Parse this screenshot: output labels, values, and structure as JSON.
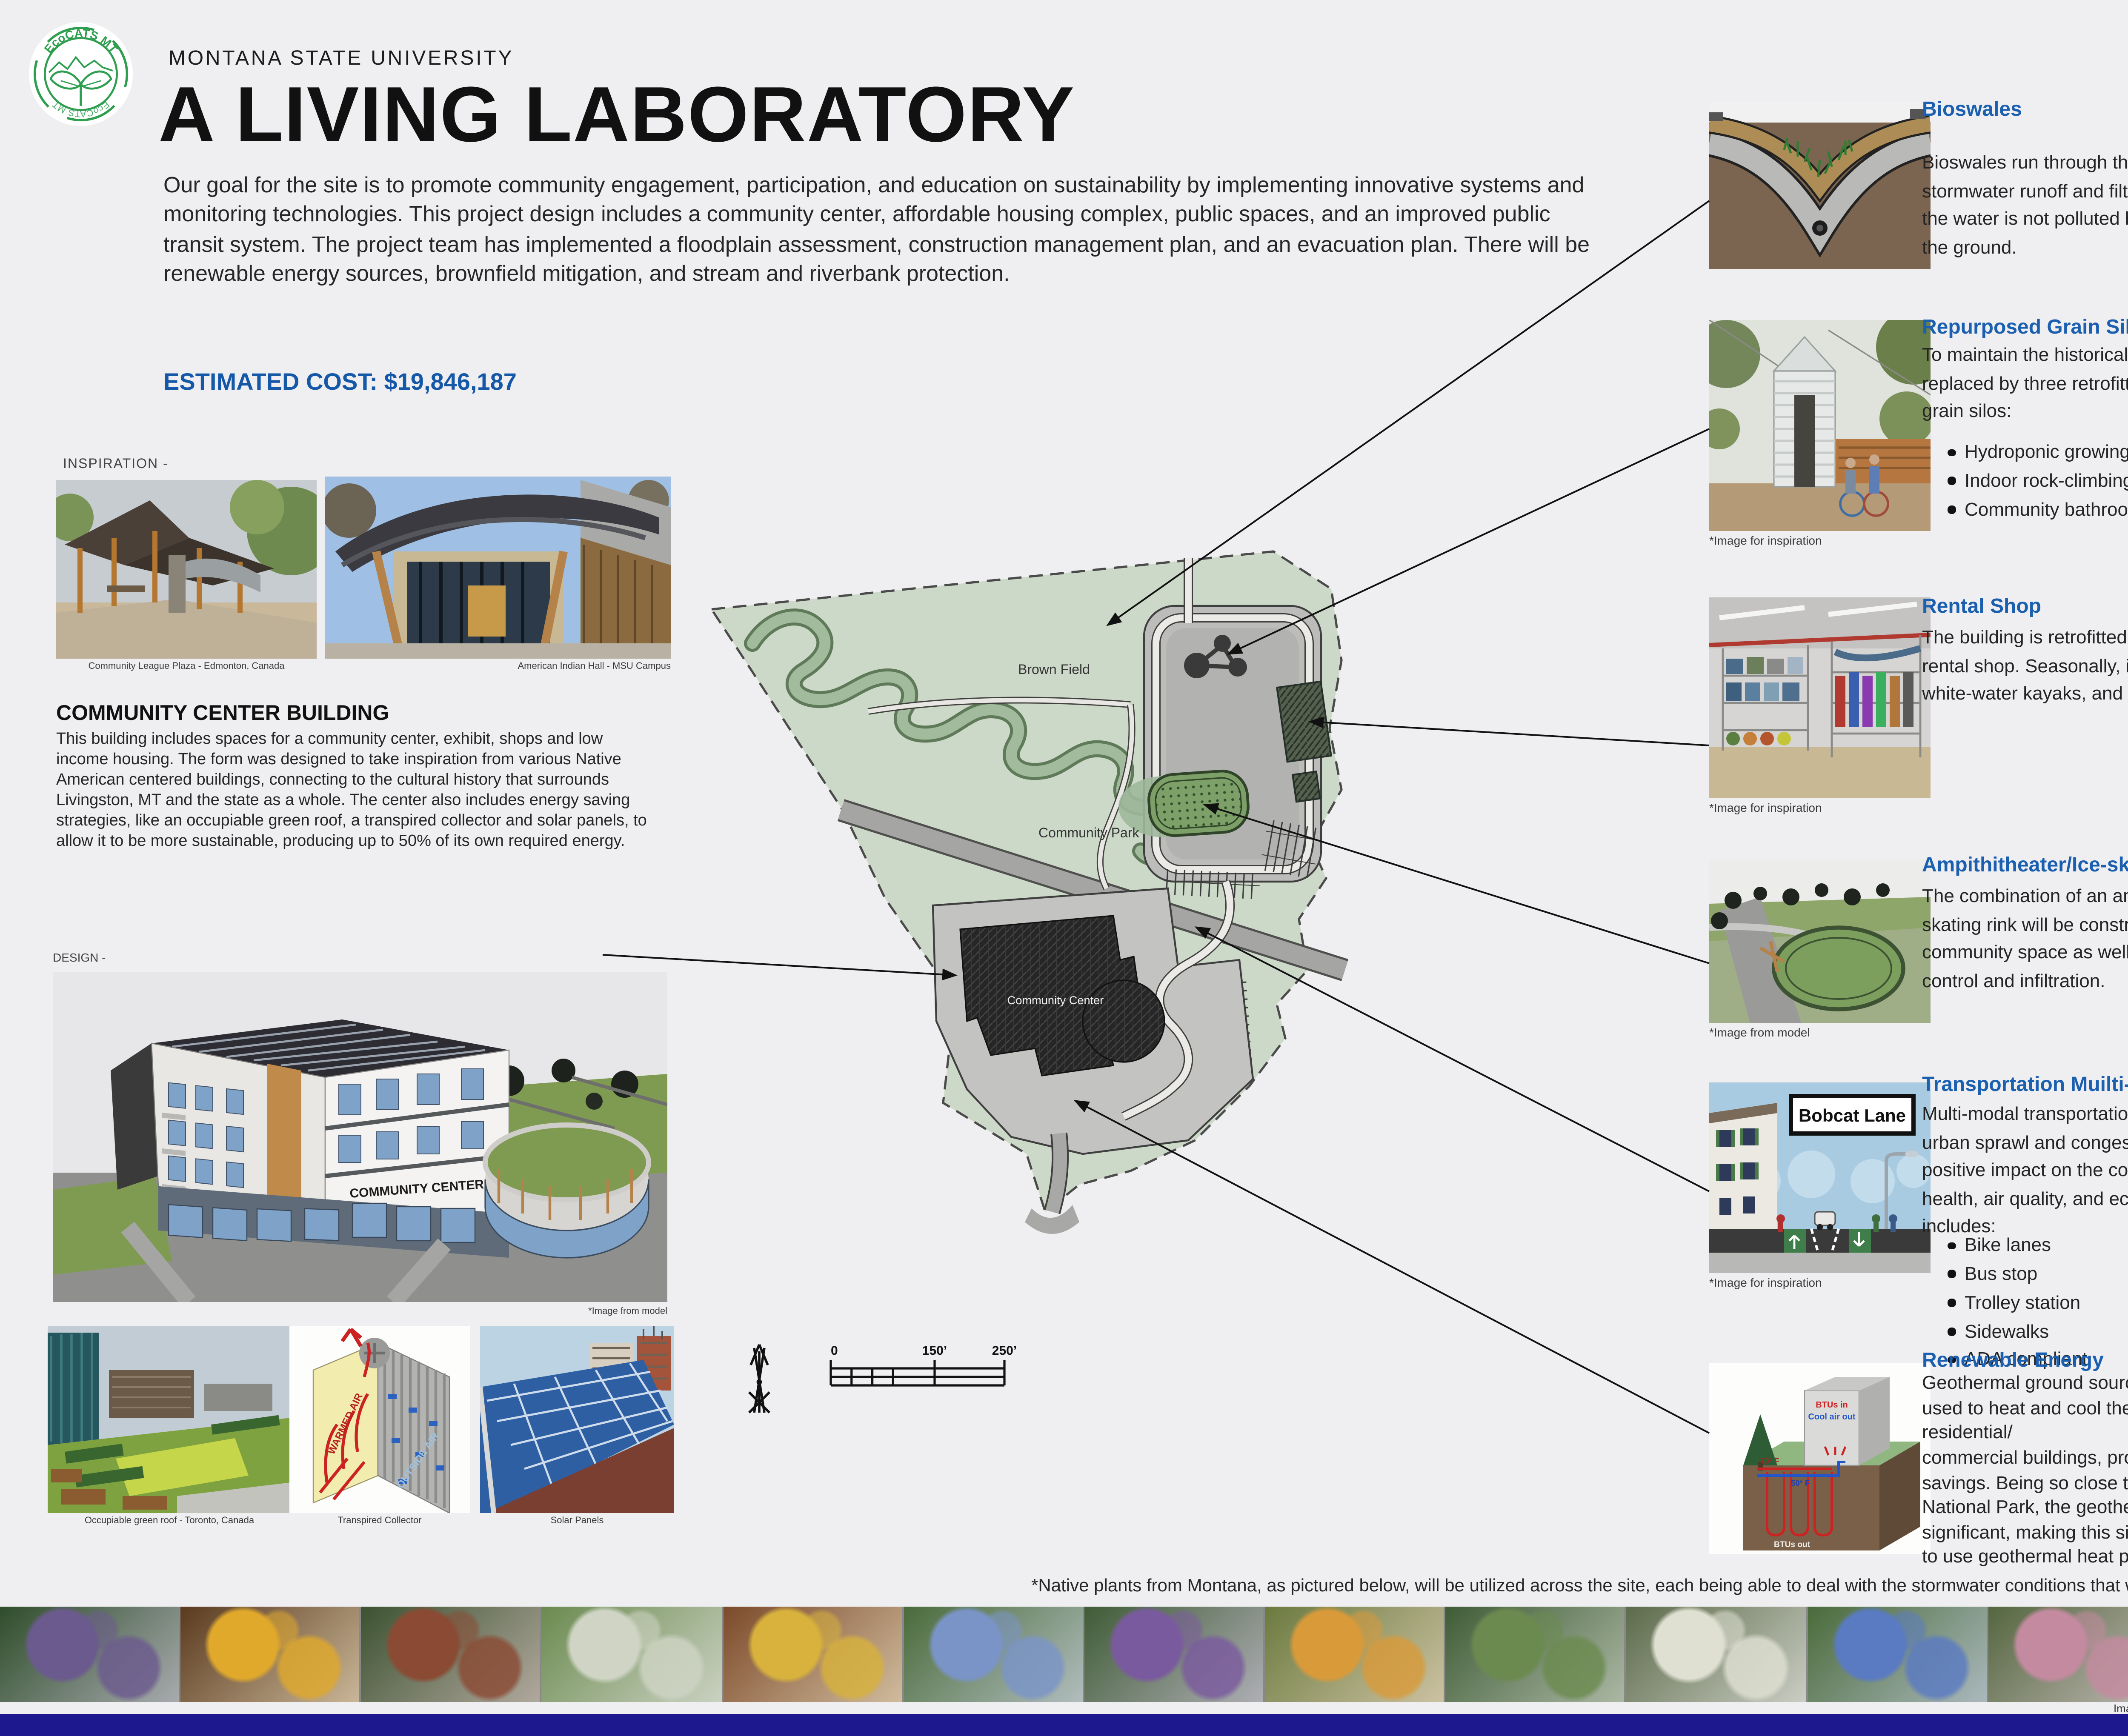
{
  "header": {
    "logo_text": "EcoCATS MT",
    "university": "MONTANA STATE UNIVERSITY",
    "title": "A LIVING LABORATORY",
    "intro": "Our goal for the site is to promote community engagement, participation, and education on sustainability by implementing innovative systems and monitoring technologies. This project design includes a community center, affordable housing complex, public spaces, and an improved public transit system. The project team has implemented a floodplain assessment, construction management plan, and an evacuation plan. There will be renewable energy sources, brownfield mitigation, and stream and riverbank protection.",
    "estimated_cost": "ESTIMATED COST: $19,846,187"
  },
  "inspiration": {
    "label": "INSPIRATION -",
    "caption_left": "Community League Plaza - Edmonton, Canada",
    "caption_right": "American Indian Hall - MSU Campus"
  },
  "community_center": {
    "heading": "COMMUNITY CENTER BUILDING",
    "body": "This building includes spaces for a community center, exhibit, shops and low income housing.  The form was designed to take inspiration from various Native American centered buildings, connecting to the cultural history that surrounds Livingston, MT and the state as a whole.  The center also includes energy saving strategies, like an occupiable green roof, a transpired collector and solar panels, to allow it to be more sustainable, producing up to 50% of its own required energy.",
    "design_label": "DESIGN -",
    "model_caption": "*Image from model",
    "building_sign": "COMMUNITY CENTER",
    "photo_caption_1": "Occupiable green roof - Toronto, Canada",
    "photo_caption_2": "Transpired Collector",
    "photo_caption_3": "Solar Panels"
  },
  "map": {
    "label_brown_field": "Brown Field",
    "label_community_park": "Community Park",
    "label_community_center": "Community Center",
    "scale_0": "0",
    "scale_150": "150’",
    "scale_250": "250’"
  },
  "sections": [
    {
      "title": "Bioswales",
      "body": "Bioswales run through the site to help manage stormwater runoff and filter the water, ensuring the water is not polluted before it is returned to the ground."
    },
    {
      "title": "Repurposed Grain Silos",
      "body": "To maintain the historical image, the silos are replaced by three retrofitted, refurbished metal grain silos:",
      "bullets": [
        "Hydroponic growing system greenhouse",
        "Indoor rock-climbing wall",
        "Community bathroom"
      ],
      "caption": "*Image for inspiration"
    },
    {
      "title": "Rental Shop",
      "body": "The building is retrofitted and reused as a rental shop. Seasonally, it will supply bikes, white-water kayaks, and ice skates.",
      "caption": "*Image for inspiration"
    },
    {
      "title": "Ampithitheater/Ice-skating Rink",
      "body": "The combination of an amphitheater and ice-skating rink will be constructed. providing community space as well as added flood water control and infiltration.",
      "caption": "*Image from model"
    },
    {
      "title": "Transportation Muilti-modal Overview",
      "body": "Multi-modal transportation systems reduce urban sprawl and congestion, having a positive impact on the community’s public health, air quality, and economy.  This site includes:",
      "bullets": [
        "Bike lanes",
        "Bus stop",
        "Trolley station",
        "Sidewalks",
        "ADA compliant"
      ],
      "caption": "*Image for inspiration",
      "sign": "Bobcat Lane"
    },
    {
      "title": "Renewable Energy",
      "body": "Geothermal ground source heat pumps are used to heat and cool the greenhouse and residential/\ncommercial buildings, providing 30% energy savings. Being so close to Yellowstone National Park, the geothermal capabilities are significant, making this site a prime candidate to use geothermal heat pumps."
    }
  ],
  "diagram_labels": {
    "geo_btus_in": "BTUs in",
    "geo_cool_air": "Cool air out",
    "geo_70": "70° F",
    "geo_50": "50° F",
    "geo_btus_out": "BTUs out",
    "collector_warm": "WARMED AIR",
    "collector_outside": "OUTSIDE AIR"
  },
  "footer": {
    "note": "*Native plants from Montana, as pictured below, will be utilized across the site, each being able to deal with the stormwater conditions that will be forever present.",
    "image_source": "Image Source: https://mtnativeplants.org/",
    "plant_tiles": [
      [
        "#6b5a8e",
        "#2e4d2a"
      ],
      [
        "#e0a92c",
        "#5a3a1f"
      ],
      [
        "#8a4a33",
        "#3c5231"
      ],
      [
        "#cfd4c4",
        "#6b8a4f"
      ],
      [
        "#d8b23c",
        "#7c4a2a"
      ],
      [
        "#7a94c8",
        "#4a6b3a"
      ],
      [
        "#7a5a9e",
        "#3f5c36"
      ],
      [
        "#d99a3a",
        "#6b7a3f"
      ],
      [
        "#6b8a4f",
        "#3f5c36"
      ],
      [
        "#dfe0d2",
        "#5c6b4a"
      ],
      [
        "#5a7ac2",
        "#4a6b3a"
      ],
      [
        "#c48aa0",
        "#54663f"
      ],
      [
        "#8a9a5f",
        "#4a5a33"
      ]
    ]
  },
  "colors": {
    "accent_blue": "#1a5fb0",
    "cost_blue": "#1558a8",
    "navy_bar": "#1e188f",
    "site_green": "#cdd9c8",
    "stream_green": "#9fb89b",
    "rink_green": "#7d9f68",
    "background": "#efeef0"
  }
}
